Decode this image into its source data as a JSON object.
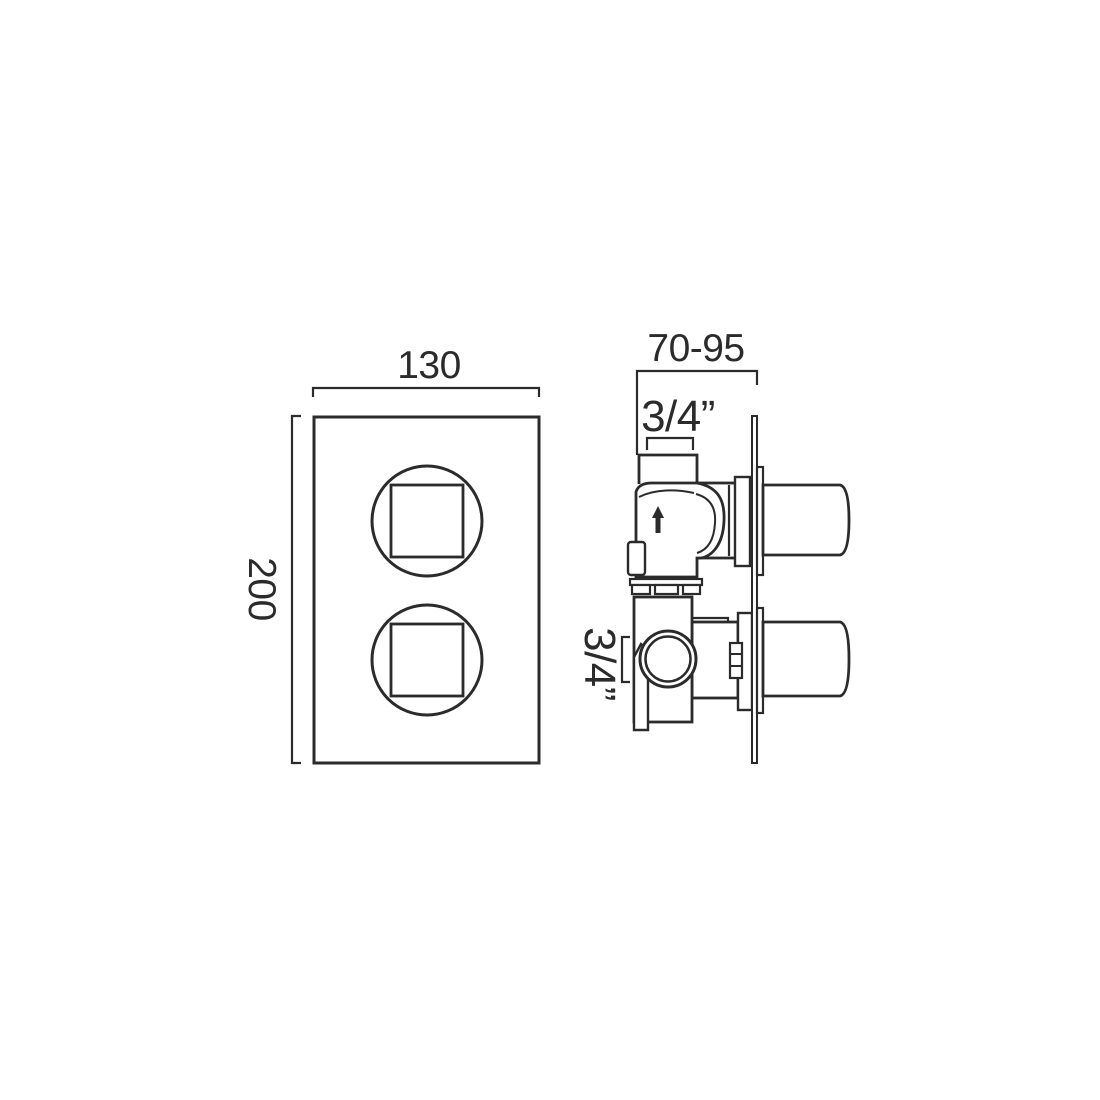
{
  "drawing": {
    "background": "#ffffff",
    "line_color": "#2b2b2b",
    "text_color": "#2b2b2b",
    "front_view": {
      "width_label": "130",
      "height_label": "200"
    },
    "side_view": {
      "depth_range_label": "70-95",
      "top_inlet_size_label": "3/4”",
      "side_port_size_label": "3/4”"
    }
  }
}
